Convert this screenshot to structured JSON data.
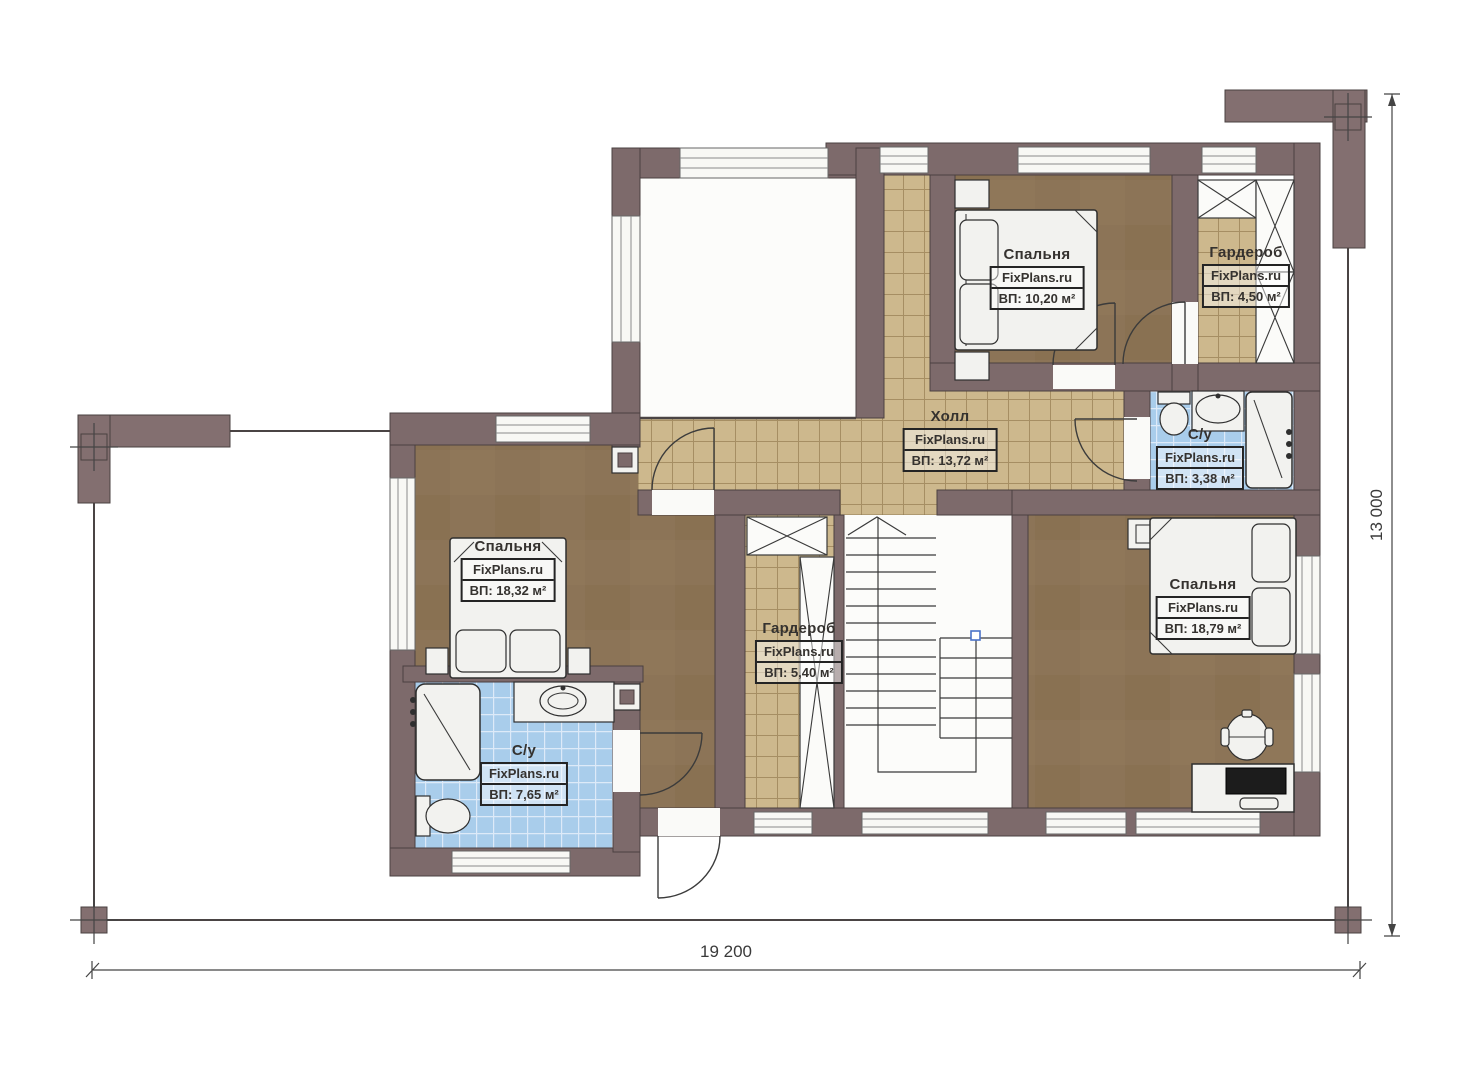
{
  "plan": {
    "watermark": "FixPlans.ru",
    "dimensions": {
      "width_label": "19 200",
      "height_label": "13 000"
    }
  },
  "rooms": [
    {
      "id": "bedroom-top",
      "name": "Спальня",
      "watermark": "FixPlans.ru",
      "area": "ВП: 10,20 м²"
    },
    {
      "id": "wardrobe-top",
      "name": "Гардероб",
      "watermark": "FixPlans.ru",
      "area": "ВП: 4,50 м²"
    },
    {
      "id": "hall",
      "name": "Холл",
      "watermark": "FixPlans.ru",
      "area": "ВП: 13,72 м²"
    },
    {
      "id": "bathroom-top",
      "name": "С/у",
      "watermark": "FixPlans.ru",
      "area": "ВП: 3,38 м²"
    },
    {
      "id": "bedroom-left",
      "name": "Спальня",
      "watermark": "FixPlans.ru",
      "area": "ВП: 18,32 м²"
    },
    {
      "id": "wardrobe-center",
      "name": "Гардероб",
      "watermark": "FixPlans.ru",
      "area": "ВП: 5,40 м²"
    },
    {
      "id": "bedroom-right",
      "name": "Спальня",
      "watermark": "FixPlans.ru",
      "area": "ВП: 18,79 м²"
    },
    {
      "id": "bathroom-left",
      "name": "С/у",
      "watermark": "FixPlans.ru",
      "area": "ВП: 7,65 м²"
    }
  ],
  "colors": {
    "wall": "#7d6a6b",
    "bedroom_floor": "#8c7457",
    "hall_tile": "#cdb88d",
    "tile_grout": "#a68e63",
    "bath_tile": "#a9cdeb",
    "bath_grout": "#ddeaf8",
    "furniture": "#f2f2ef",
    "line": "#3b3b3b",
    "stairs_marker": "#4a72c8"
  }
}
